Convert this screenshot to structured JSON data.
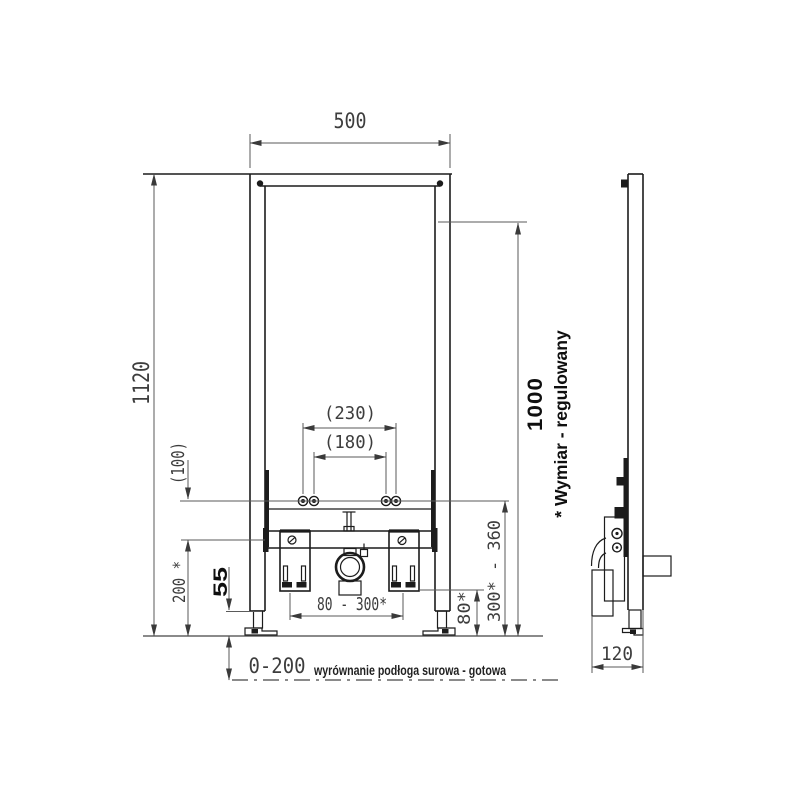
{
  "drawing": {
    "type": "installation-frame-technical-drawing",
    "views": {
      "front": "front-view",
      "side": "side-view"
    }
  },
  "dims": {
    "width_top": "500",
    "height_total": "1120",
    "bolt_spacing_outer": "(230)",
    "bolt_spacing_inner": "(180)",
    "bolt_to_crossbar": "(100)",
    "top_fixing_height": "1000",
    "adjustable_note": "* Wymiar - regulowany",
    "bolt_height_range": "300* - 360",
    "bracket_height": "80*",
    "bracket_range": "80 - 300*",
    "crossbar_height": "200 *",
    "foot_exposed": "55",
    "floor_leveling_range": "0-200",
    "floor_note": "wyrównanie podłoga surowa - gotowa",
    "frame_depth": "120"
  },
  "colors": {
    "background": "#ffffff",
    "frame_line": "#1c1c1c",
    "dim_line": "#5a5a5a",
    "dim_text": "#3d3d3d",
    "bold_text": "#0f0f0f"
  }
}
